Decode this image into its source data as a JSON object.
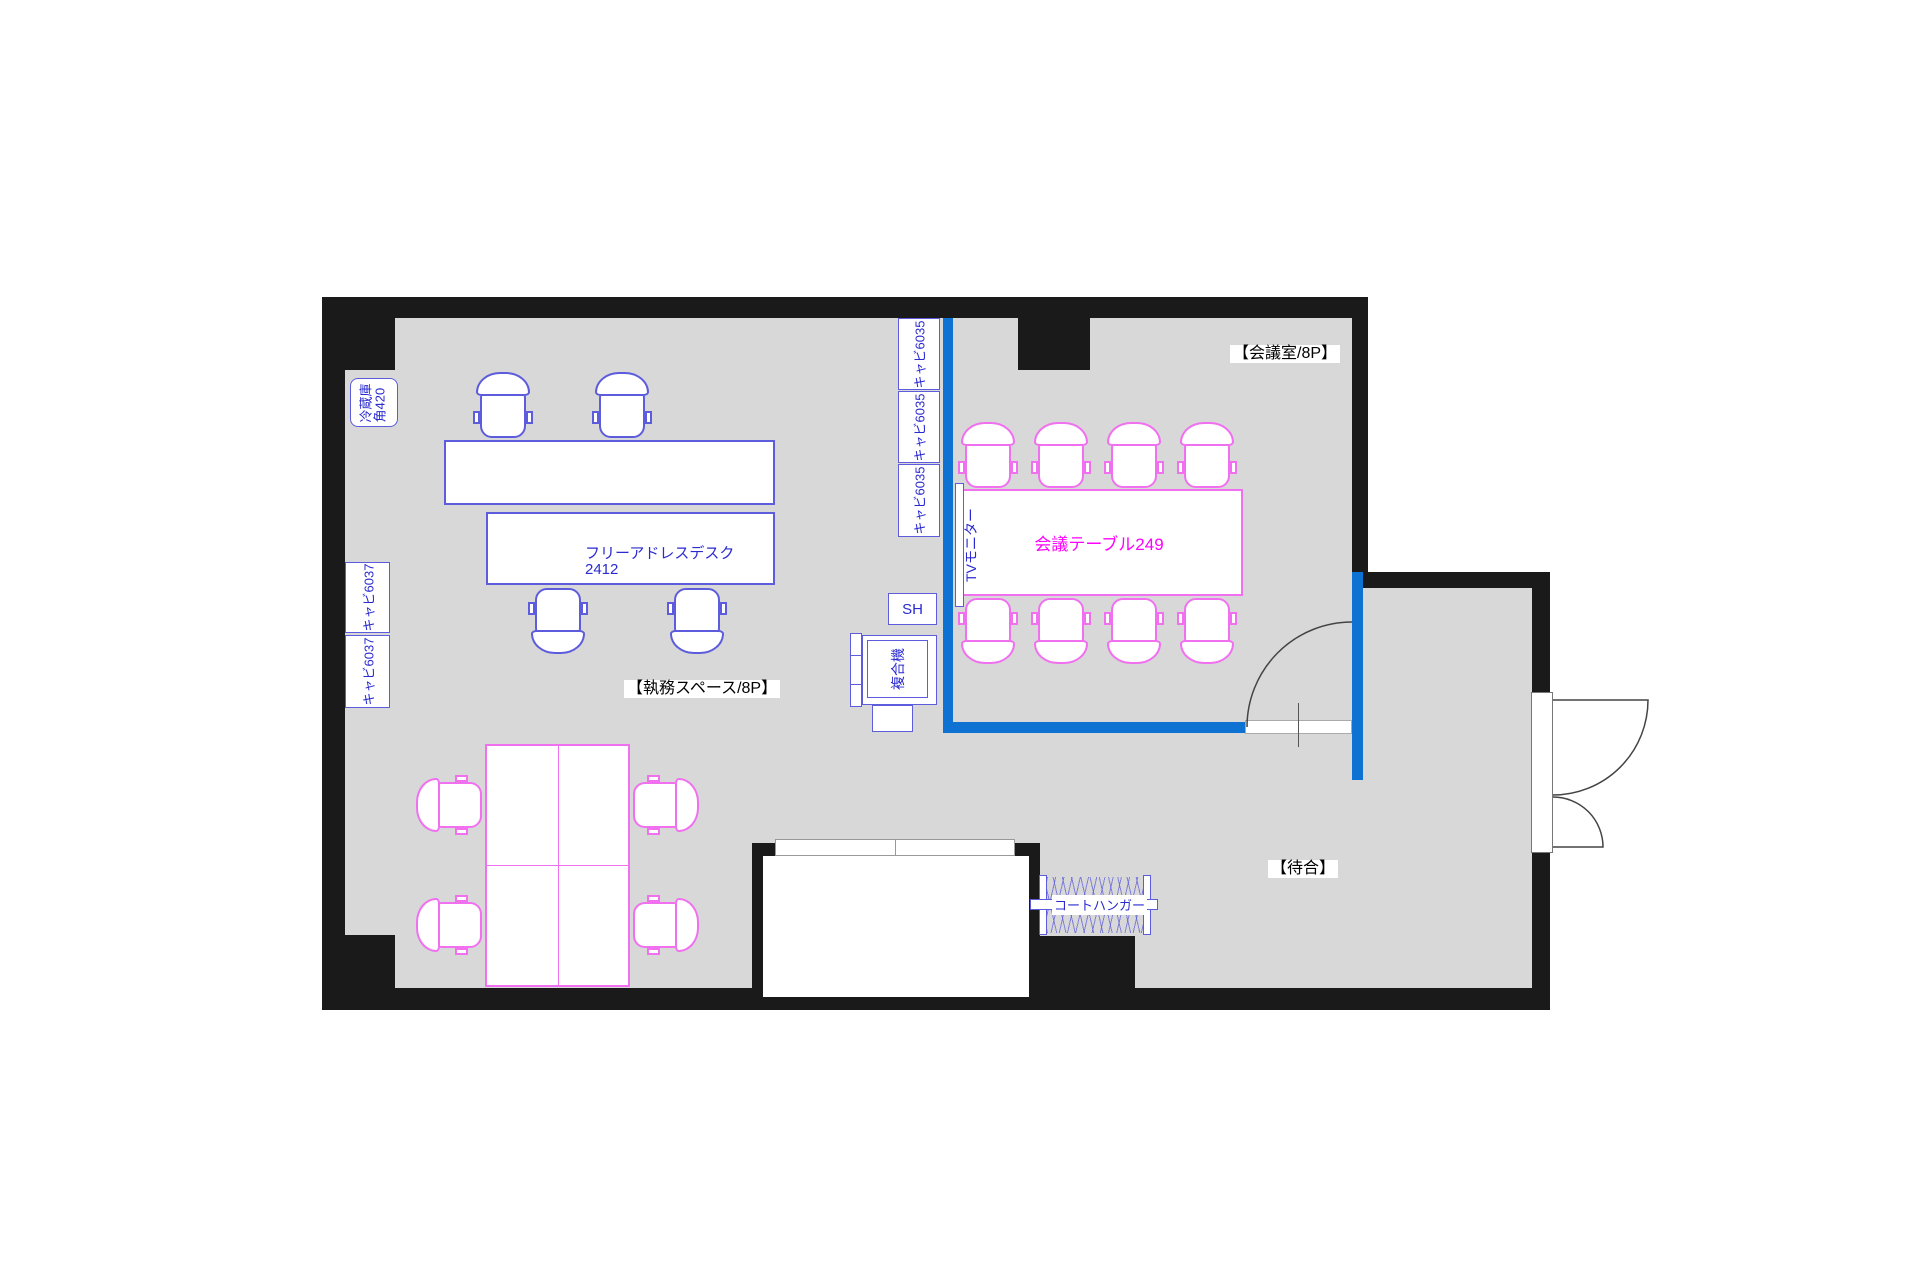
{
  "plan": {
    "title": "office-floor-plan",
    "rooms": {
      "meeting_room_label": "【会議室/8P】",
      "work_space_label": "【執務スペース/8P】",
      "waiting_label": "【待合】"
    },
    "furniture": {
      "refrigerator": "冷蔵庫\n角420",
      "cabinet_6037": "キャビ6037",
      "cabinet_6035": "キャビ6035",
      "free_desk_line1": "フリーアドレスデスク",
      "free_desk_line2": "2412",
      "meeting_table": "会議テーブル249",
      "tv_monitor": "TVモニター",
      "copier": "複合機",
      "shelf": "SH",
      "coat_hanger": "コートハンガー"
    },
    "colors": {
      "wall": "#1a1a1a",
      "floor": "#d8d8d8",
      "partition_blue": "#0d72d2",
      "furniture_blue": "#5c5cdc",
      "furniture_pink": "#f070f0",
      "text_blue": "#2a2ad0",
      "text_magenta": "#ff00ff"
    }
  }
}
